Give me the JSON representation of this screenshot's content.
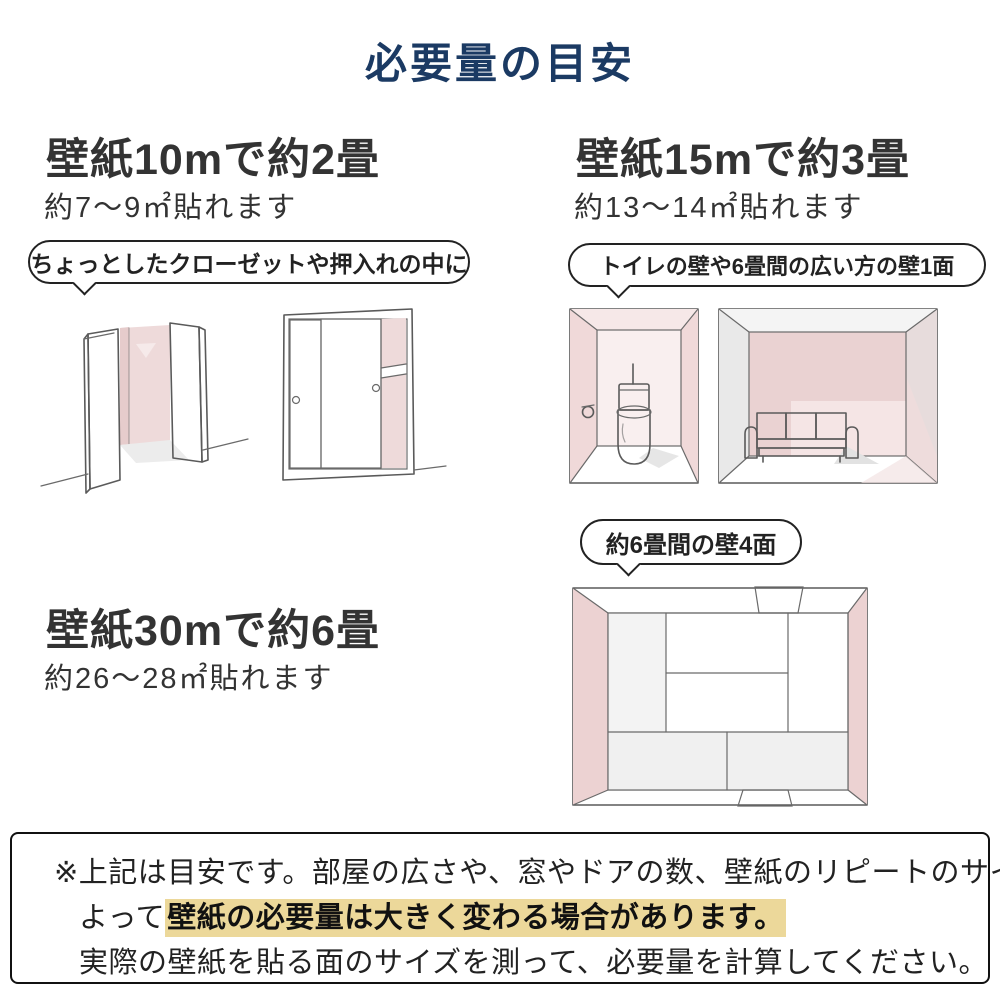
{
  "title": "必要量の目安",
  "colors": {
    "title_navy": "#1b3a63",
    "text_dark": "#333333",
    "pink_wall": "#f0d9d9",
    "pink_wall_dark": "#e9cdcd",
    "pink_wall_light": "#f6e8e8",
    "gray_wall": "#e9e9e9",
    "sketch_line": "#5a5a5a",
    "highlight_yellow": "#ecd89a"
  },
  "sections": {
    "s10": {
      "heading": "壁紙10mで約2畳",
      "sub": "約7〜9㎡貼れます",
      "bubble": "ちょっとしたクローゼットや押入れの中に",
      "illustrations": [
        "open-closet",
        "sliding-closet"
      ]
    },
    "s15": {
      "heading": "壁紙15mで約3畳",
      "sub": "約13〜14㎡貼れます",
      "bubble": "トイレの壁や6畳間の広い方の壁1面",
      "illustrations": [
        "toilet-room",
        "living-room"
      ]
    },
    "s30": {
      "heading": "壁紙30mで約6畳",
      "sub": "約26〜28㎡貼れます",
      "bubble": "約6畳間の壁4面",
      "illustrations": [
        "tatami-room"
      ]
    }
  },
  "note": {
    "line1": "※上記は目安です。部屋の広さや、窓やドアの数、壁紙のリピートのサイズなどに",
    "line2_prefix": "よって",
    "line2_highlight": "壁紙の必要量は大きく変わる場合があります。",
    "line3": "実際の壁紙を貼る面のサイズを測って、必要量を計算してください。"
  }
}
